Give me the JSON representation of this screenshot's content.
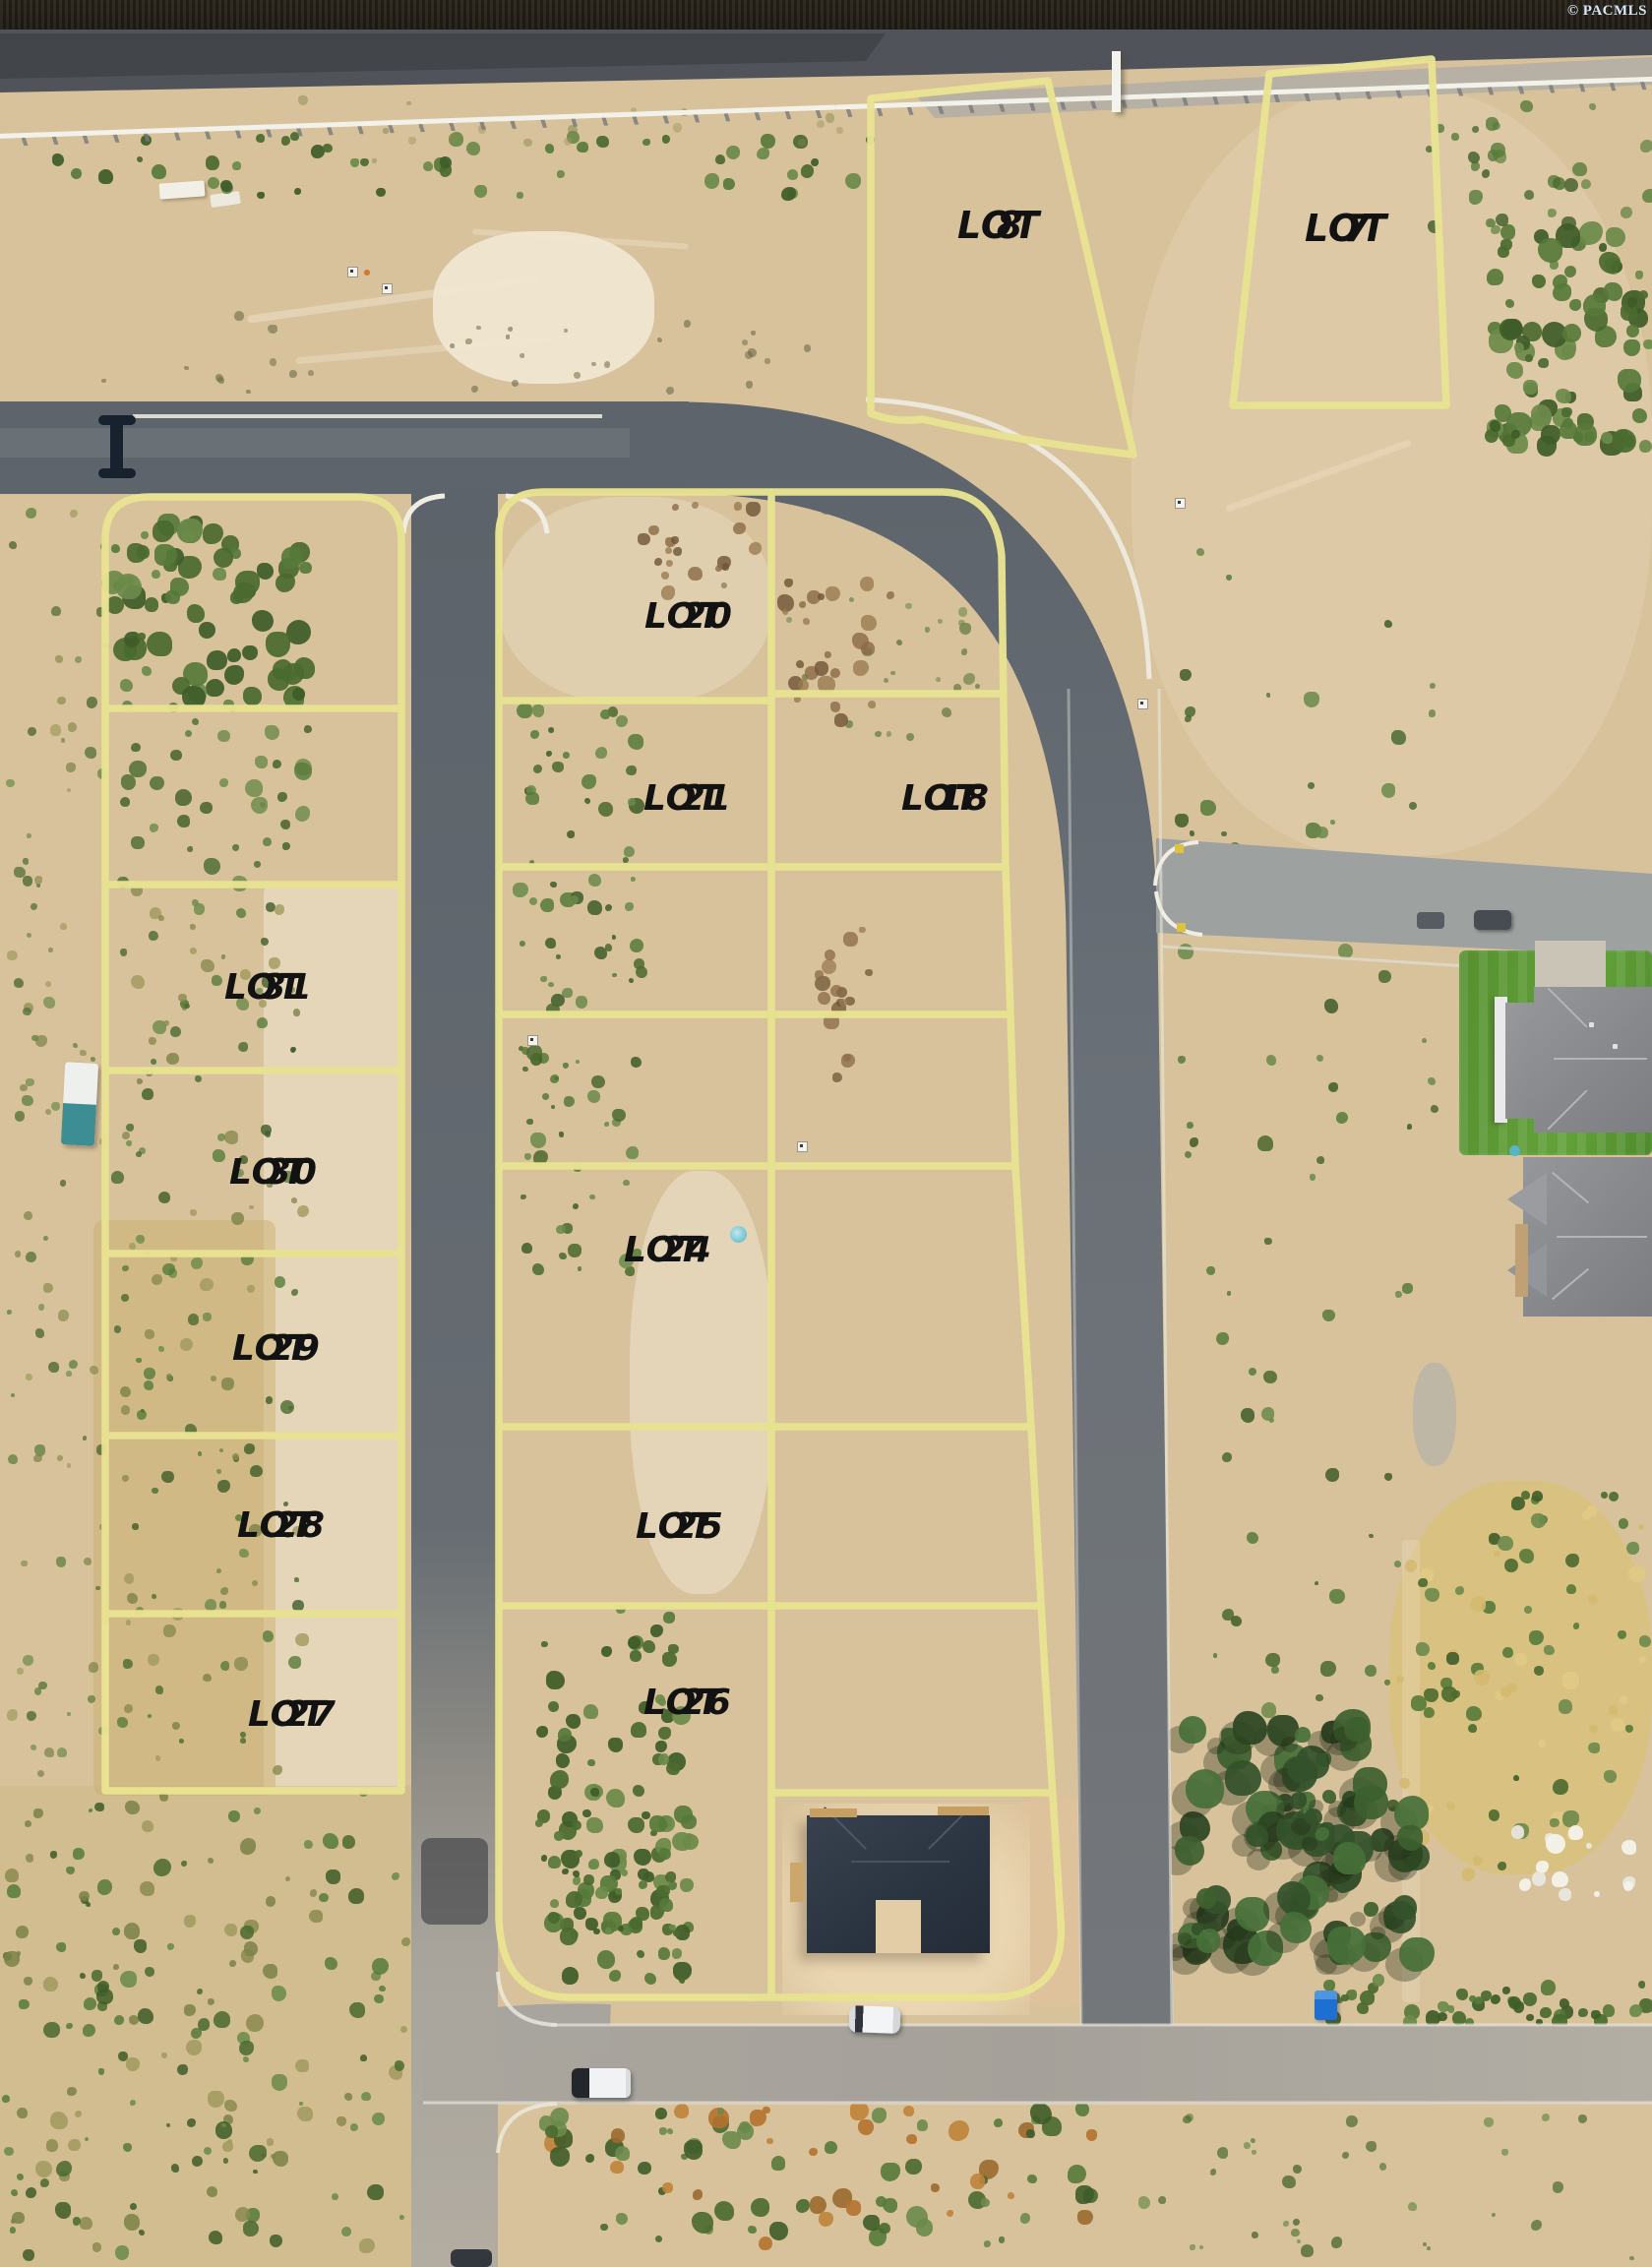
{
  "watermark": "© PACMLS",
  "colors": {
    "lot_line": "#e8e392",
    "label_text": "#121212",
    "watermark_text": "#d7e5f5"
  },
  "lots": {
    "lot7": {
      "label": "LOT",
      "number": "7"
    },
    "lot8": {
      "label": "LOT",
      "number": "8"
    },
    "lot18": {
      "label": "LOT",
      "number": "18"
    },
    "lot20": {
      "label": "LOT",
      "number": "20"
    },
    "lot21": {
      "label": "LOT",
      "number": "21"
    },
    "lot24": {
      "label": "LOT",
      "number": "24"
    },
    "lot25": {
      "label": "LOT",
      "number": "25"
    },
    "lot26": {
      "label": "LOT",
      "number": "26"
    },
    "lot27": {
      "label": "LOT",
      "number": "27"
    },
    "lot28": {
      "label": "LOT",
      "number": "28"
    },
    "lot29": {
      "label": "LOT",
      "number": "29"
    },
    "lot30": {
      "label": "LOT",
      "number": "30"
    },
    "lot31": {
      "label": "LOT",
      "number": "31"
    }
  }
}
